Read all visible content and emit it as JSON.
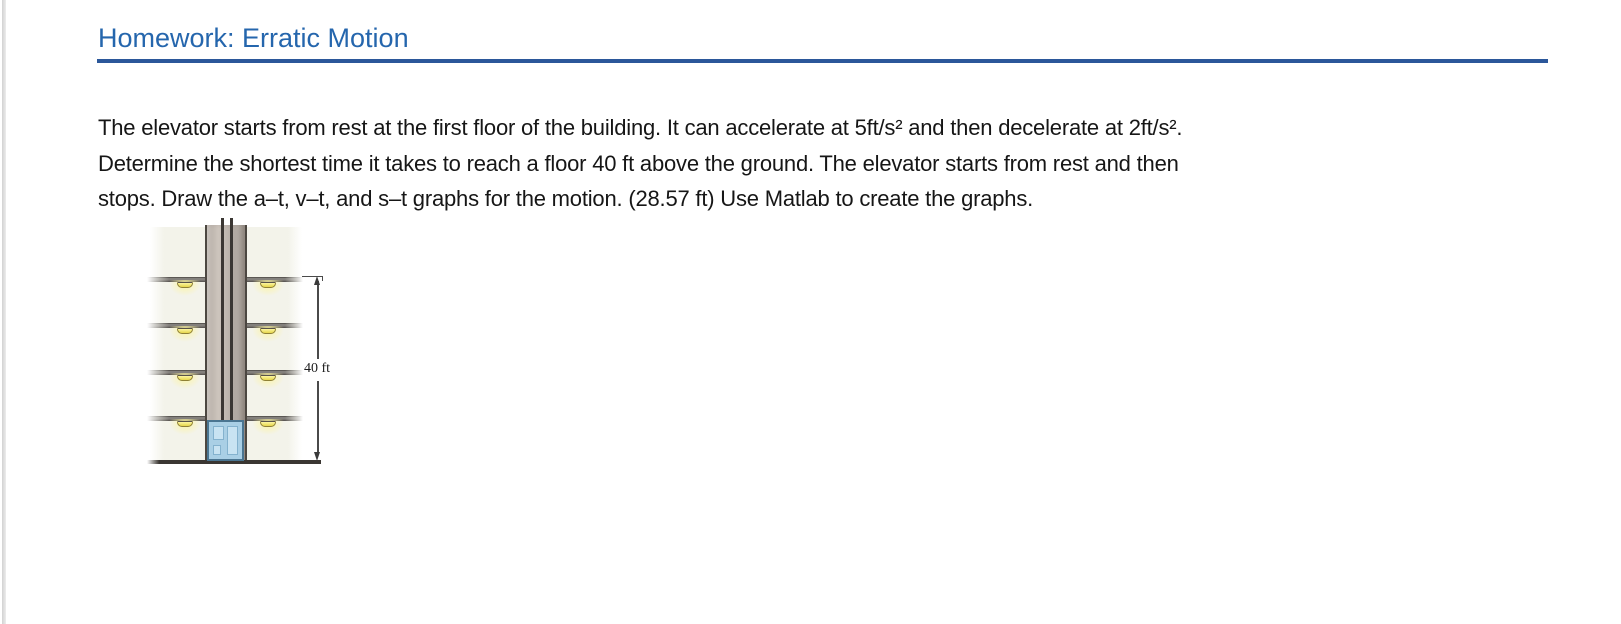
{
  "header": {
    "title": "Homework: Erratic Motion"
  },
  "problem": {
    "lines": [
      "The elevator starts from rest at the first floor of the building. It can accelerate at 5ft/s² and then decelerate at 2ft/s².",
      "Determine the shortest time it takes to reach a floor 40 ft above the ground. The elevator starts from rest and then",
      "stops. Draw the a–t, v–t, and s–t graphs for the motion. (28.57 ft) Use Matlab to create the graphs."
    ]
  },
  "figure": {
    "dimension_label": "40 ft",
    "floor_count": 4,
    "colors": {
      "building_interior": "#f3f3ea",
      "shaft": "#c2bab2",
      "ceiling_light": "#f0e468",
      "elevator_car": "#a9cfe5"
    }
  },
  "colors": {
    "title_blue": "#2566ad",
    "rule_blue": "#2b579a",
    "body_text": "#161616"
  }
}
